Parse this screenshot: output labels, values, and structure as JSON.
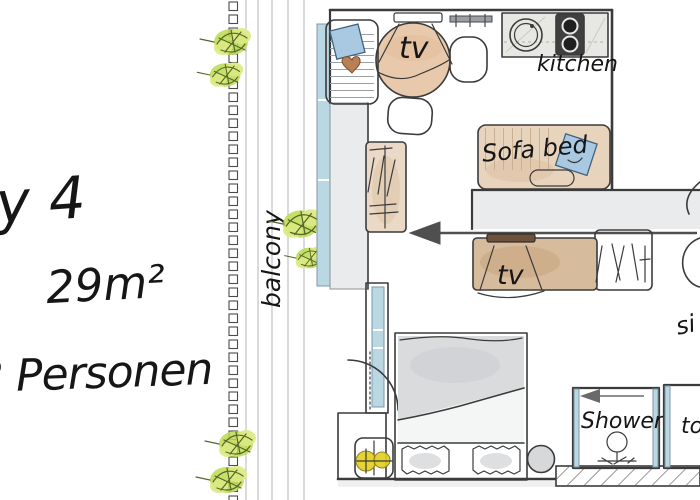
{
  "info": {
    "line1": "ry 4",
    "area": "29m²",
    "capacity": "2 Personen"
  },
  "plan": {
    "labels": {
      "balcony": "balcony",
      "kitchen": "kitchen",
      "sofa_bed": "Sofa bed",
      "tv_dining": "tv",
      "tv_lounge": "tv",
      "shower": "Shower",
      "toilet": "to",
      "sink": "si"
    },
    "icons": {
      "entrance_arrow": "◄",
      "shower_arrow": "◄"
    },
    "colors": {
      "ink": "#161616",
      "outline": "#3b3b3b",
      "wood": "#e9c9ab",
      "wood_dark": "#cfa27e",
      "sofa": "#e8d3bd",
      "sideboard": "#d7bb9d",
      "wardrobe": "#ead9c7",
      "plant": "#bcd94f",
      "plant_light": "#dcea82",
      "plant_dark": "#55682a",
      "glass": "#bad7e4",
      "pillow_blue": "#a9c9e3",
      "pillow_blue_dark": "#41617d",
      "heart": "#b97f55",
      "lamp": "#e3cf1e",
      "wall": "#e9ebec",
      "bed_gray": "#d9dbdd",
      "stool": "#d6d8da",
      "stove": "#3f3f3f",
      "arrow": "#4f4f4f",
      "plank": "#b9bcbe",
      "counter": "#e7e8e4"
    }
  }
}
